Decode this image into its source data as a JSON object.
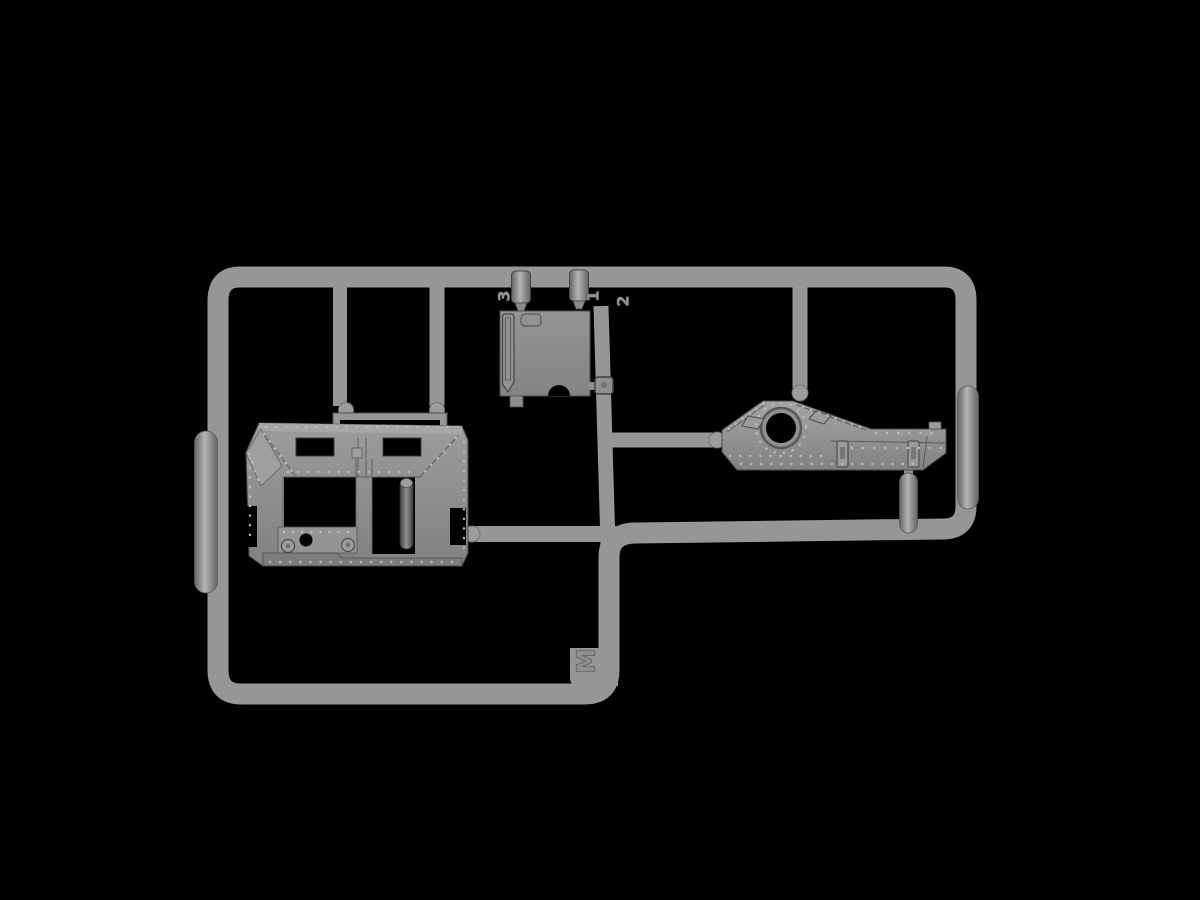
{
  "scene": {
    "background_color": "#000000",
    "sprue_color": "#969696",
    "gate_color": "#9c9c9c",
    "part_color": "#8e8e8e",
    "plate_color": "#8c8c8c",
    "pad_color": "#969696",
    "outline_color": "#4a4a4a",
    "rivet_color": "#bdbdbd",
    "opening_color": "#000000",
    "label_fill_color": "#919191",
    "label_outline_color": "#474747"
  },
  "sprue": {
    "letter": "M",
    "part_numbers": [
      "3",
      "1",
      "2"
    ],
    "description": "Injection-molded model kit sprue with armored hull parts"
  },
  "labels": {
    "part_3": "3",
    "part_1": "1",
    "part_2": "2",
    "sprue_letter": "M"
  }
}
